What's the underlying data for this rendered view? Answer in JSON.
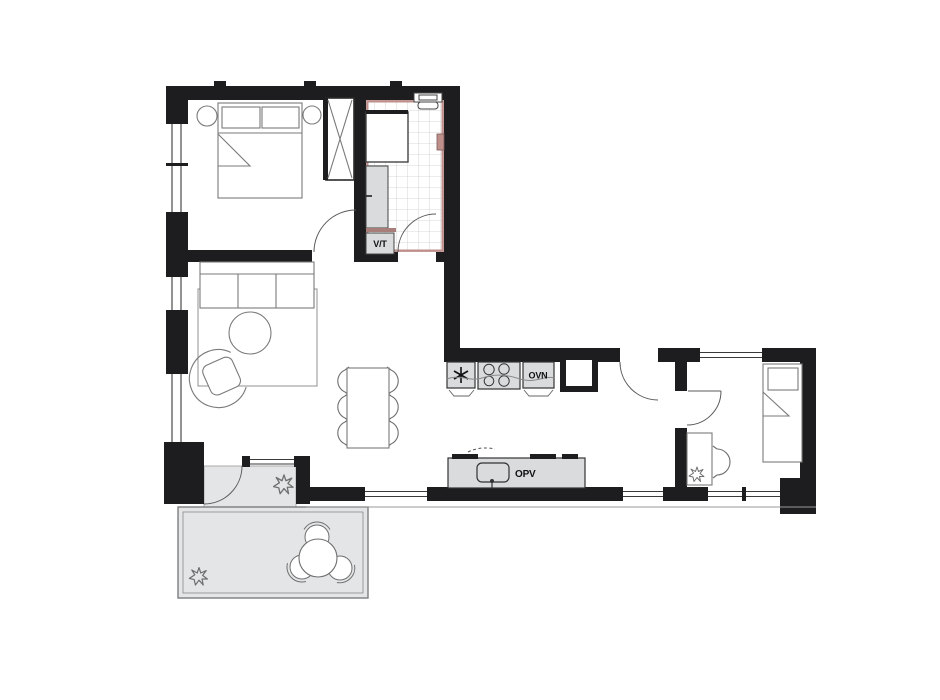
{
  "plan": {
    "title_present": false,
    "labels": {
      "washer_dryer": "V/T",
      "oven": "OVN",
      "dishwasher": "OPV"
    },
    "colors": {
      "wall": "#1d1d1f",
      "bathroom_accent": "#bf8f8c",
      "bathroom_counter_edge": "#a87e7b",
      "fixture_fill": "#d9dbdd",
      "balcony_fill": "#e4e5e6",
      "furniture_line": "#7a7a7a",
      "tile_line": "#cccccc",
      "window_line": "#3a3a3a",
      "background": "#ffffff"
    },
    "icons": {
      "freezer": "asterisk-icon",
      "cooktop": "burners-icon",
      "sink": "sink-icon",
      "plant": "plant-icon",
      "toilet": "toilet-icon",
      "shower": "shower-icon",
      "door_swing": "quarter-arc"
    }
  }
}
